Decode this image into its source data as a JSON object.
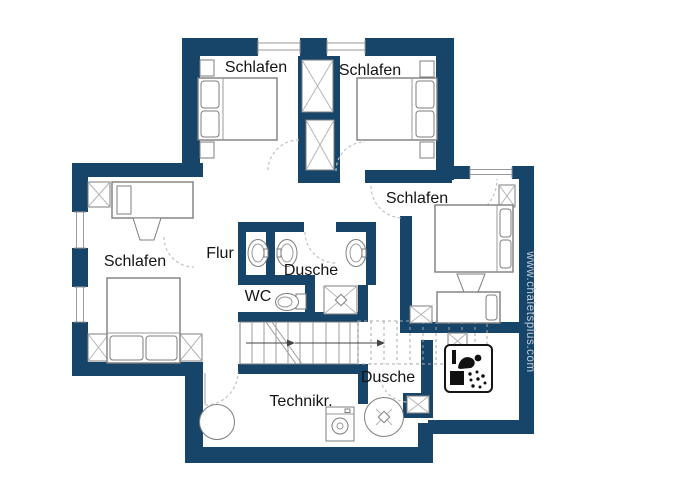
{
  "watermark": "www.chaletsplus.com",
  "labels": {
    "bedroom_top_left": "Schlafen",
    "bedroom_top_right": "Schlafen",
    "bedroom_right": "Schlafen",
    "bedroom_left": "Schlafen",
    "hallway": "Flur",
    "shower_middle": "Dusche",
    "wc": "WC",
    "shower_bottom": "Dusche",
    "technical_room": "Technikr."
  },
  "colors": {
    "wall": "#164569",
    "furn": "#7d7d7d",
    "thin": "#9a9a9a",
    "dash": "#c2c2c2",
    "label": "#141414",
    "wm": "#c3cdda",
    "arrow": "#444444",
    "icon": "#101010"
  }
}
